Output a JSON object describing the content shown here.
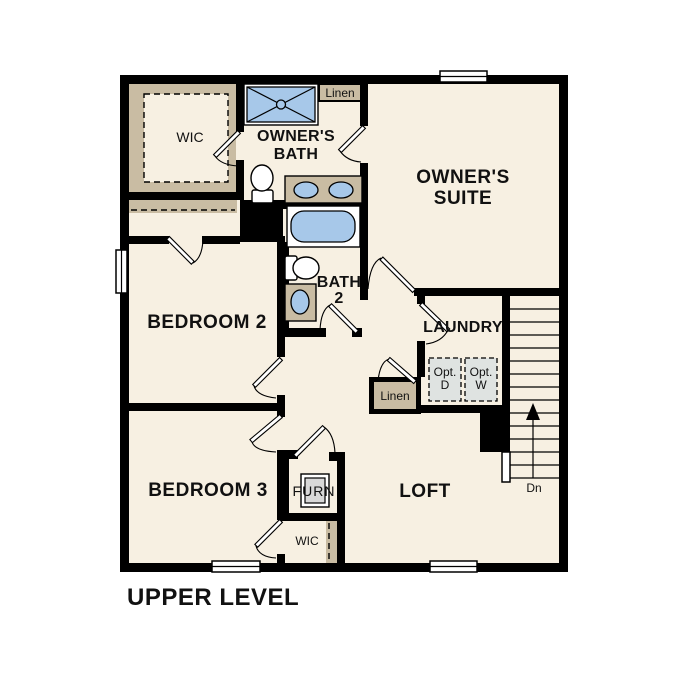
{
  "caption": "UPPER LEVEL",
  "colors": {
    "wall": "#000000",
    "floor": "#F7F0E2",
    "closet_tan": "#C9BCA3",
    "fixture_blue": "#A7C8E9",
    "appliance_gray": "#DFE3E1",
    "furnace_gray": "#D8D8D8",
    "text": "#111111"
  },
  "labels": {
    "wic_top": "WIC",
    "linen_top": "Linen",
    "owners_bath_1": "OWNER'S",
    "owners_bath_2": "BATH",
    "owners_suite_1": "OWNER'S",
    "owners_suite_2": "SUITE",
    "bedroom2": "BEDROOM 2",
    "bath2_1": "BATH",
    "bath2_2": "2",
    "laundry": "LAUNDRY",
    "opt_d_1": "Opt.",
    "opt_d_2": "D",
    "opt_w_1": "Opt.",
    "opt_w_2": "W",
    "linen_mid": "Linen",
    "bedroom3": "BEDROOM 3",
    "furn": "FURN",
    "loft": "LOFT",
    "wic_bottom": "WIC",
    "stairs_dn": "Dn"
  },
  "fixtures": [
    "shower",
    "double-vanity-sinks",
    "toilet-owners-bath",
    "bathtub",
    "toilet-bath2",
    "vanity-sink-bath2",
    "furnace-unit",
    "optional-dryer",
    "optional-washer",
    "stairs-down",
    "windows"
  ]
}
